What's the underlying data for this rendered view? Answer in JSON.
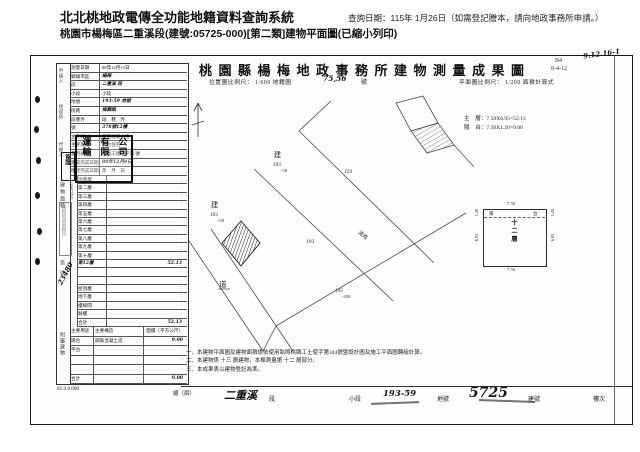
{
  "header": {
    "system_title": "北北桃地政電傳全功能地籍資料查詢系統",
    "query_date": "查詢日期：115年 1月26日（如需登記謄本，請向地政事務所申請。）",
    "subtitle": "桃園市楊梅區二重溪段(建號:05725-000)[第二類]建物平面圖(已縮小列印)"
  },
  "doc": {
    "plan_zone": "都市計劃區",
    "title": "桃園縣楊梅地政事務所建物測量成果圖",
    "corner_code1": "B4",
    "corner_code2": "8-4-12",
    "pencil_note": "9.12.16-1"
  },
  "scale": {
    "pos_text": "位置圖比例尺： 1/600 地籍圖",
    "sheet_no": "75,56",
    "sheet_unit": "號",
    "plan_text": "平面圖比例尺： 1/200 面積計算式"
  },
  "formula": {
    "line1": "主　層：7.50X6.95=52.13",
    "line2": "陽　台：7.50X1.20=9.00"
  },
  "form": {
    "applicant_labels": [
      "申請人",
      "住居所",
      "代理人"
    ],
    "seal_cols": [
      "運輸",
      "有限",
      "公司"
    ],
    "small_seal": "簽證",
    "office_seal": "楊梅地政事務所",
    "receipt_stamp": "第　號",
    "receipt_no": "23480",
    "rows": [
      {
        "label": "測量日期",
        "value": "88年12月15日"
      },
      {
        "label": "鄉鎮市區",
        "value": "楊梅",
        "hand_value": true
      },
      {
        "label": "段",
        "value": "二重溪 段",
        "hand_value": true
      },
      {
        "label": "小段",
        "value": "小段"
      },
      {
        "label": "地號",
        "value": "193-59 地號",
        "hand_value": true
      },
      {
        "label": "街路",
        "value": "梅獅路",
        "hand_value": true
      },
      {
        "label": "段巷弄",
        "value": "段　巷　弄"
      },
      {
        "label": "號",
        "value": "378號12樓",
        "hand_value": true
      },
      {
        "label": "主要建材",
        "value": "鋼筋混凝土造"
      },
      {
        "label": "主要用途",
        "value": "集合住宅"
      },
      {
        "label": "使用執照",
        "value": "桃縣工建使字第 號"
      },
      {
        "label": "建築完成日期",
        "value": "88年12月8日",
        "hand_value": true
      },
      {
        "label": "增建完成日期",
        "value": "年　月　日"
      }
    ],
    "area_strip": "建物面積",
    "area_unit": "（平方公尺）",
    "area_rows": [
      {
        "label": "地面層",
        "value": "‧"
      },
      {
        "label": "第二層",
        "value": "‧"
      },
      {
        "label": "第三層",
        "value": "‧"
      },
      {
        "label": "第四層",
        "value": "‧"
      },
      {
        "label": "第五層",
        "value": "‧"
      },
      {
        "label": "第六層",
        "value": "‧"
      },
      {
        "label": "第七層",
        "value": "‧"
      },
      {
        "label": "第八層",
        "value": "‧"
      },
      {
        "label": "第九層",
        "value": "‧"
      },
      {
        "label": "第十層",
        "value": "‧"
      },
      {
        "label": "第12層",
        "value": "52.13",
        "hand_label": true,
        "hand_value": true
      },
      {
        "label": "",
        "value": "‧"
      },
      {
        "label": "",
        "value": "‧"
      },
      {
        "label": "屋頂層",
        "value": "‧"
      },
      {
        "label": "地下層",
        "value": "‧"
      },
      {
        "label": "樓梯間",
        "value": "‧"
      },
      {
        "label": "騎樓",
        "value": "‧"
      },
      {
        "label": "合計",
        "value": "52.13",
        "hand_value": true
      }
    ],
    "annex_strip": "附屬建物",
    "annex_header": {
      "use": "主要用途",
      "structure": "主要構造",
      "area": "面積（平方公尺）"
    },
    "annex_rows": [
      {
        "use": "陽台",
        "structure": "鋼筋混凝土造",
        "area": "9.00",
        "hand_area": true
      },
      {
        "use": "平台",
        "structure": "",
        "area": "‧"
      },
      {
        "use": "",
        "structure": "",
        "area": "‧"
      },
      {
        "use": "",
        "structure": "",
        "area": "‧"
      },
      {
        "use": "合計",
        "structure": "",
        "area": "9.00",
        "hand_area": true
      }
    ],
    "form_code": "85.9.8.000",
    "sheet_note": "縮（兩）"
  },
  "notes": {
    "n1": "一、本建物平面圖及建物面積係依使用執照桃縣工土使字第344號暨設計圖及施工平面圖轉繪計算。",
    "n2": "二、本建物係 十三 層建物，本棟測量第 十二 層部分。",
    "n3": "三、本成果表以建物登記為準。"
  },
  "bottom_strip": {
    "section": "二重溪",
    "section_label": "段",
    "xiaoduan_label": "小段",
    "parcel": "193-59",
    "parcel_label": "地號",
    "building_no": "5725",
    "building_label": "建號",
    "floor_label": "樓次"
  },
  "site_plan": {
    "b1_prefix": "建",
    "b1_no": "193",
    "b1_sub": "-58",
    "p193_top": "193",
    "b2_prefix": "建",
    "b2_no": "193",
    "b2_sub": "-59",
    "p193_mid": "193",
    "p195": "195",
    "p195_sub": "-458",
    "road": "道",
    "road_name": "道路"
  },
  "floor_plan": {
    "dim_top": "7.50",
    "dim_bottom": "7.50",
    "dim_left_top": "1.20",
    "dim_left": "6.95",
    "dim_right_top": "1.20",
    "dim_right": "6.95",
    "center": "十二層",
    "balcony_l": "陽",
    "balcony_r": "台"
  }
}
